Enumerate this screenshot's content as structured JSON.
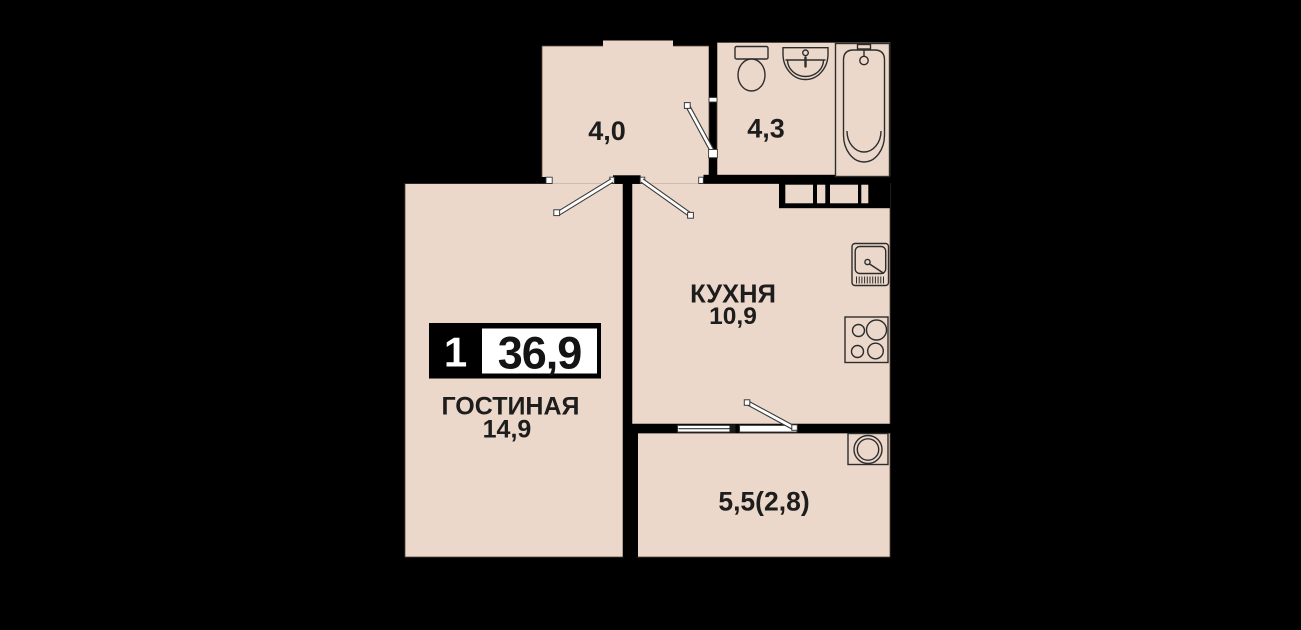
{
  "floorplan": {
    "badge": {
      "rooms_count": "1",
      "total_area": "36,9"
    },
    "rooms": {
      "hallway": {
        "area": "4,0"
      },
      "bathroom": {
        "area": "4,3"
      },
      "kitchen": {
        "name": "КУХНЯ",
        "area": "10,9"
      },
      "living": {
        "name": "ГОСТИНАЯ",
        "area": "14,9"
      },
      "balcony": {
        "area": "5,5(2,8)"
      }
    },
    "colors": {
      "background": "#000000",
      "floor_fill": "#EBD8CA",
      "wall": "#000000",
      "fixture_line": "#2D2D2D",
      "text": "#1D1D1D",
      "badge_bg": "#000000",
      "badge_value_bg": "#FFFFFF"
    }
  }
}
